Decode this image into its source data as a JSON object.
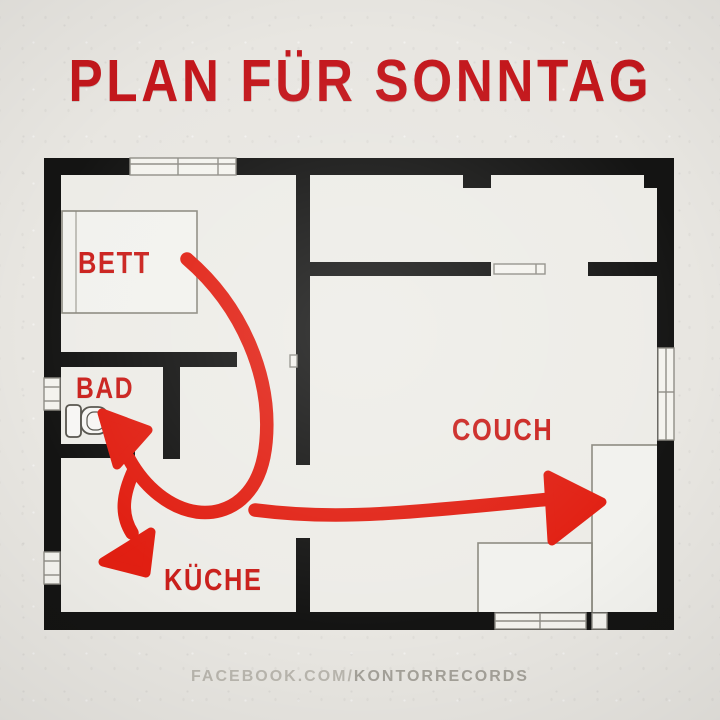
{
  "title": "PLAN FÜR SONNTAG",
  "floor_plan": {
    "rooms": [
      {
        "id": "bett",
        "label": "BETT",
        "furniture": "bed"
      },
      {
        "id": "bad",
        "label": "BAD",
        "furniture": "toilet"
      },
      {
        "id": "kueche",
        "label": "KÜCHE",
        "furniture": ""
      },
      {
        "id": "couch",
        "label": "COUCH",
        "furniture": "l-shaped-couch"
      }
    ],
    "route": [
      {
        "step": 1,
        "from": "BETT",
        "to": "BAD"
      },
      {
        "step": 2,
        "from": "BAD",
        "to": "KÜCHE"
      },
      {
        "step": 3,
        "from": "KÜCHE",
        "to": "COUCH"
      }
    ]
  },
  "watermark": {
    "prefix": "FACEBOOK.COM/",
    "brand": "KONTORRECORDS"
  },
  "colors": {
    "title_red": "#c3171c",
    "label_red": "#ca1f1b",
    "arrow_red": "#e11f12",
    "wall_black": "#141413",
    "paper": "#e8e6e1",
    "interior": "#edece7",
    "outline_gray": "#8f8d86",
    "watermark_prefix": "#b9b6ae",
    "watermark_brand": "#a4a199"
  }
}
